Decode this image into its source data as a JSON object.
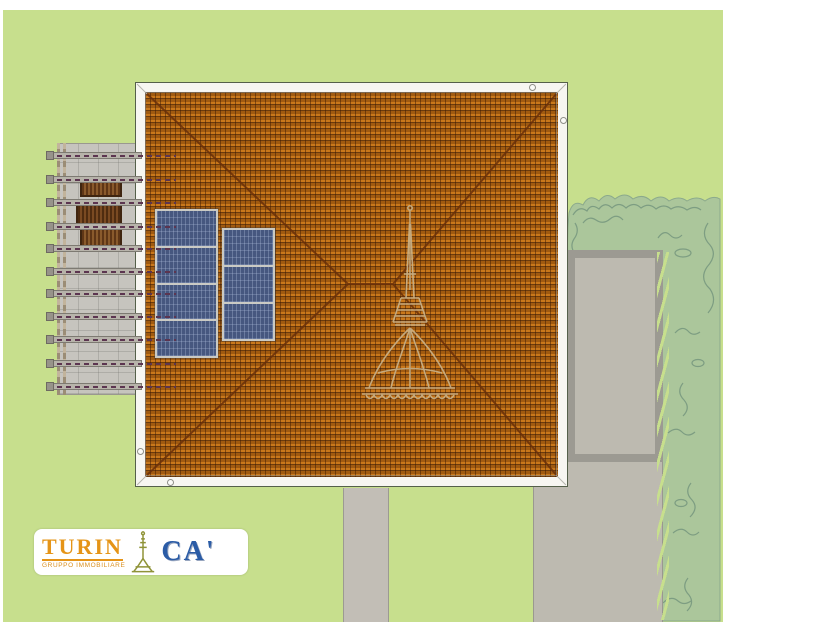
{
  "branding": {
    "wordmark_left": "TURIN",
    "wordmark_right": "CA'",
    "tagline": "GRUPPO IMMOBILIARE",
    "icon": "mole-antonelliana-icon",
    "colors": {
      "wordmark_left": "#e59417",
      "wordmark_right": "#2b5ca6",
      "tagline": "#d98f1f",
      "icon": "#8f9338",
      "plate": "#ffffff"
    }
  },
  "scene": {
    "type": "aerial-roof-plan-rendering",
    "watermark_icon": "mole-antonelliana-watermark",
    "solar": {
      "left_panel_modules": 4,
      "right_panel_modules": 3
    },
    "pergola_beam_count": 11,
    "roof_vent_count": 4,
    "colors": {
      "lawn": "#c7df8d",
      "roof_tiles": "#b2660f",
      "roof_fascia": "#f7f6f1",
      "solar_panels": "#46577f",
      "pergola_deck": "#c6c4be",
      "wood_furniture": "#7a4a26",
      "paving": "#bdbab0",
      "vegetation": "#abc69b",
      "margin": "#ffffff"
    }
  }
}
